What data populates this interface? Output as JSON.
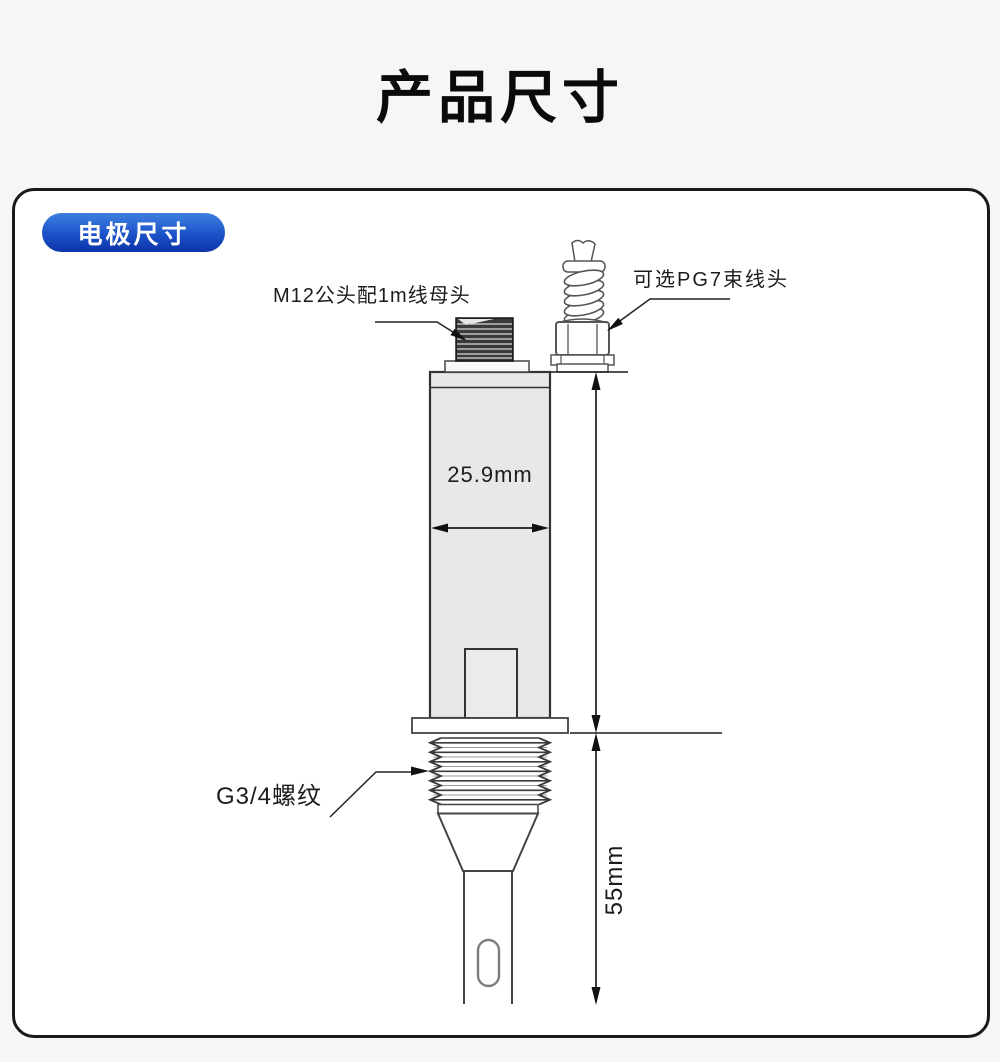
{
  "page": {
    "title": "产品尺寸"
  },
  "panel": {
    "badge_label": "电极尺寸"
  },
  "diagram": {
    "labels": {
      "m12_connector": "M12公头配1m线母头",
      "pg7_gland": "可选PG7束线头",
      "g34_thread": "G3/4螺纹"
    },
    "dimensions": {
      "body_width": "25.9mm",
      "probe_length": "55mm"
    },
    "colors": {
      "badge_top": "#3f80e0",
      "badge_bottom": "#0c33a8",
      "body_fill": "#e8e8e8",
      "outline": "#333333",
      "dimension_line": "#1a1a1a",
      "panel_border": "#191919",
      "page_background": "#f6f6f6"
    }
  }
}
